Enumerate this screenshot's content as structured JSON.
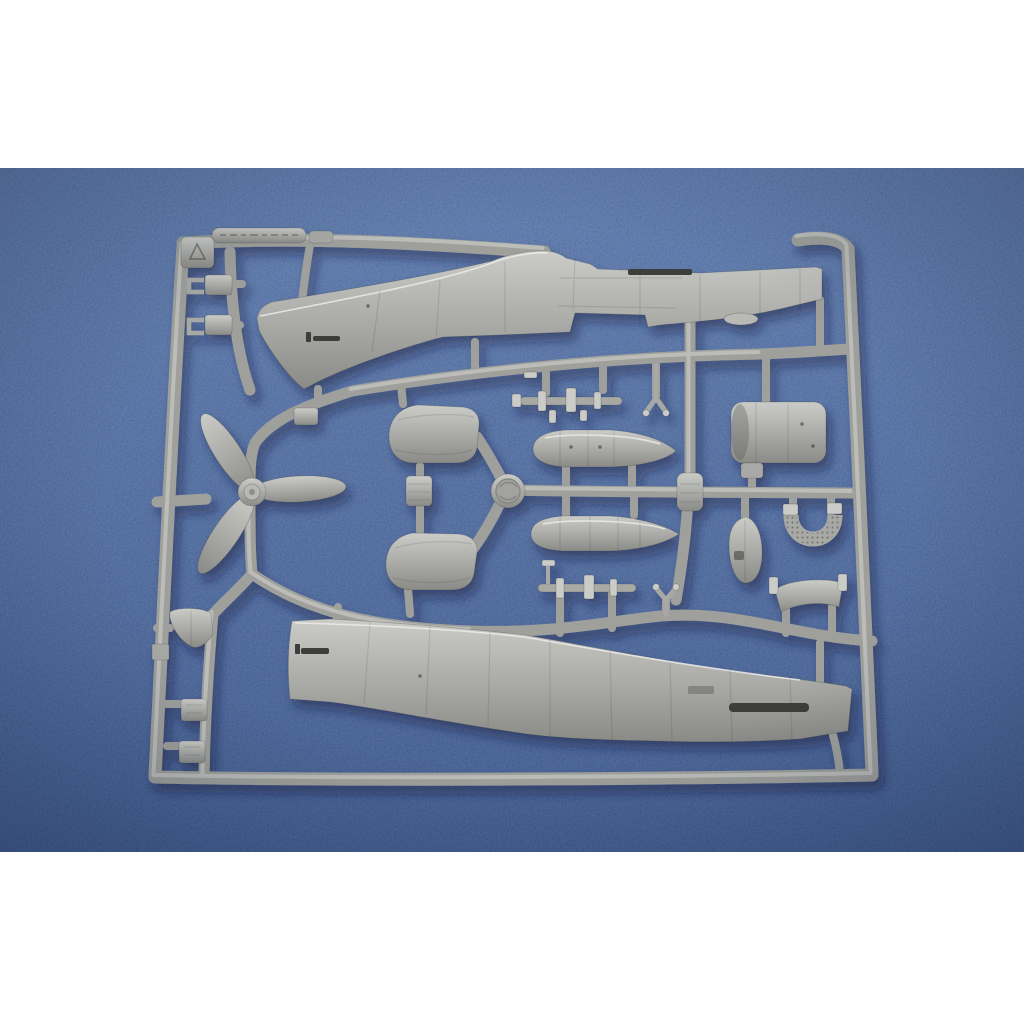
{
  "scene": {
    "kind": "product-photograph",
    "subject": "Unassembled light-gray plastic model kit sprue with aircraft parts, photographed on a blue textured fabric background",
    "letterbox": "white bands at top and bottom",
    "embossed_plate_text": "illegible raised lettering",
    "logo_disc_text": "illegible embossed maker logo"
  },
  "colors": {
    "page-white": "#ffffff",
    "bg-blue": "#40619a",
    "bg-blue-light": "#6b86b8",
    "bg-blue-dark": "#32507e",
    "plastic": "#a8a9a5",
    "plastic-light": "#cbccc8",
    "plastic-dark": "#8a8b87",
    "slot-dark": "#3c3c3a",
    "runner": "#9fa09c",
    "runner-light": "#c6c7c3"
  },
  "sprue": {
    "material_look": "light gray injection-molded plastic",
    "frame": "rounded rectangular runner frame with corner triangle block and embossed text plate on top rail",
    "parts": [
      {
        "name": "fuselage-half-upper",
        "desc": "fighter fuselage half, nose left, tail right"
      },
      {
        "name": "fuselage-half-lower",
        "desc": "second fuselage half, nose left, belly down-right"
      },
      {
        "name": "propeller-three-blade",
        "desc": "three-blade propeller with hub"
      },
      {
        "name": "gun-cover-panel-upper",
        "desc": "rounded cowl panel"
      },
      {
        "name": "gun-cover-panel-lower",
        "desc": "rounded cowl panel"
      },
      {
        "name": "drop-tank-upper",
        "desc": "teardrop external fuel tank, point right"
      },
      {
        "name": "drop-tank-lower",
        "desc": "teardrop external fuel tank, point right"
      },
      {
        "name": "engine-cowling",
        "desc": "cylindrical cowling section"
      },
      {
        "name": "radiator-grille",
        "desc": "horseshoe-shaped textured grille"
      },
      {
        "name": "oval-fairing",
        "desc": "small teardrop fairing"
      },
      {
        "name": "head-armor-plate",
        "desc": "curved plate with end flanges on two legs"
      },
      {
        "name": "access-panel-square",
        "desc": "small rounded square panel"
      },
      {
        "name": "bomb-rack-upper",
        "desc": "slender rack rod with fittings"
      },
      {
        "name": "bomb-rack-lower",
        "desc": "slender rack rod with fittings"
      },
      {
        "name": "y-strut-upper",
        "desc": "small Y-shaped strut"
      },
      {
        "name": "y-strut-lower",
        "desc": "small Y-shaped strut"
      },
      {
        "name": "bulkhead-shield",
        "desc": "shield-shaped bulkhead with pin"
      },
      {
        "name": "u-clip-parts",
        "desc": "two small U-bracket clips, upper left"
      },
      {
        "name": "step-clip-parts",
        "desc": "two small stepped clips, lower left"
      },
      {
        "name": "maker-logo-disc",
        "desc": "round embossed logo medallion at sprue center"
      },
      {
        "name": "embossed-text-plate",
        "desc": "raised lozenge plate with molded text on top rail"
      },
      {
        "name": "corner-triangle-block",
        "desc": "square corner block with embossed triangle"
      }
    ]
  }
}
